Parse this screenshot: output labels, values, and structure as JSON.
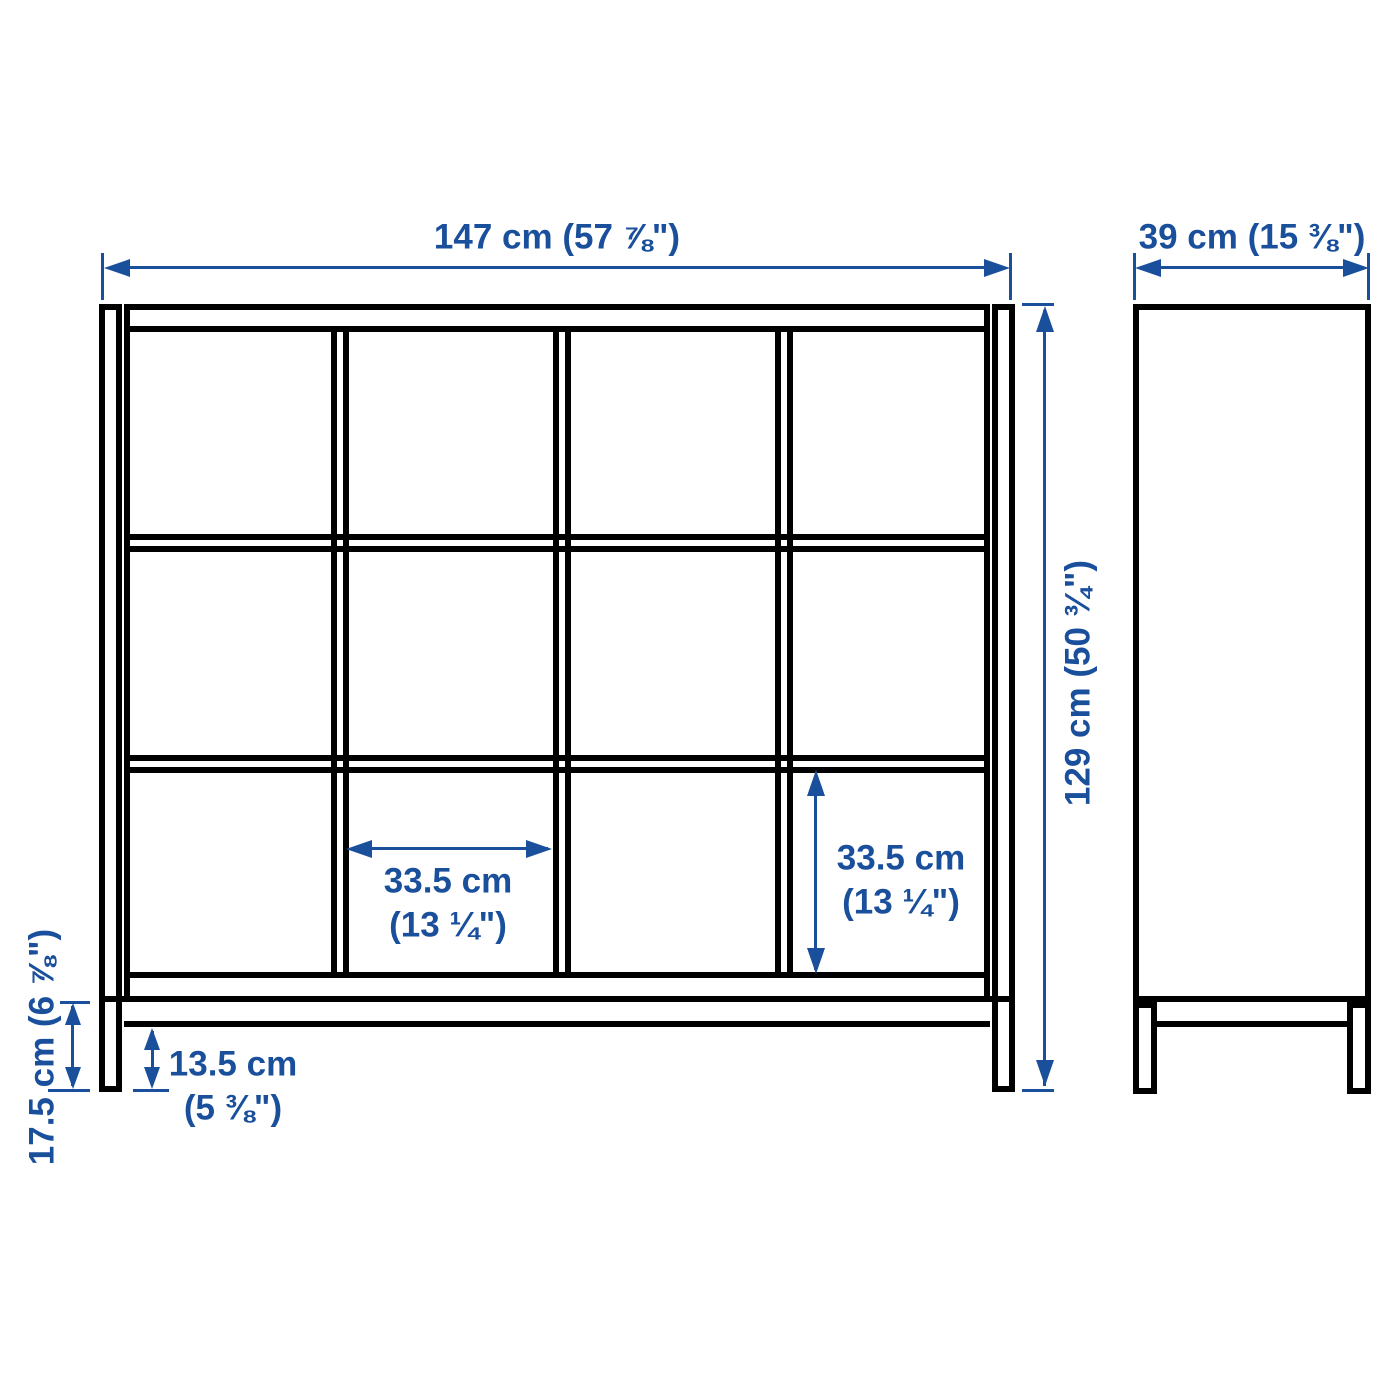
{
  "product_diagram": {
    "description": "Cube shelving unit with underframe, front and side elevation drawing",
    "views": {
      "front": {
        "grid_columns": 4,
        "grid_rows": 3
      },
      "side": {}
    },
    "dimensions": {
      "overall_width": {
        "label": "147 cm (57 ⅞\")"
      },
      "overall_depth": {
        "label": "39 cm (15 ⅜\")"
      },
      "overall_height": {
        "label": "129 cm (50 ¾\")"
      },
      "cell_width": {
        "line1": "33.5 cm",
        "line2": "(13 ¼\")"
      },
      "cell_height": {
        "line1": "33.5 cm",
        "line2": "(13 ¼\")"
      },
      "underframe_height": {
        "label": "17.5 cm (6 ⅞\")"
      },
      "underframe_clearance": {
        "line1": "13.5 cm",
        "line2": "(5 ⅜\")"
      }
    },
    "colors": {
      "dimension_blue": "#1a4f9c",
      "outline_black": "#000000",
      "background": "#ffffff"
    }
  }
}
